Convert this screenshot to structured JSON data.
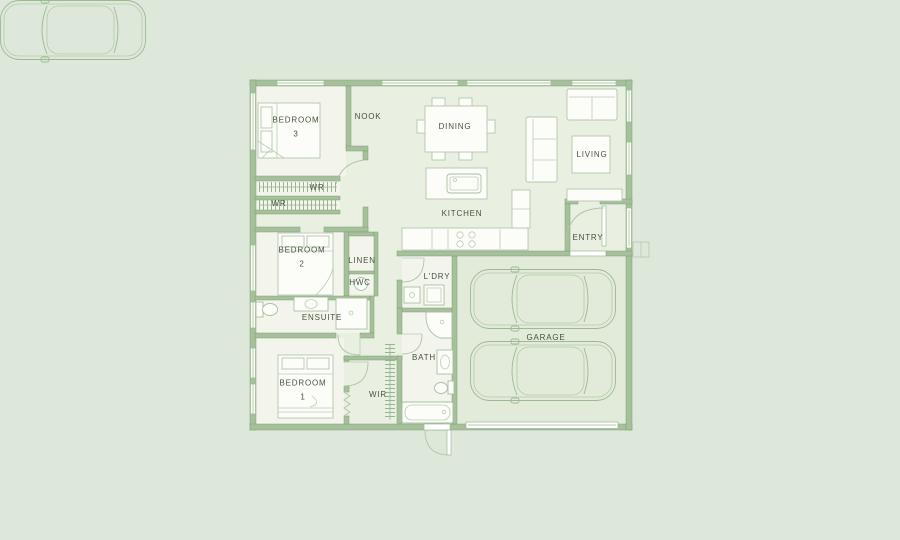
{
  "plan": {
    "colors": {
      "background": "#dee8da",
      "wall": "#a5c09a",
      "interior_floor": "#e9efe1",
      "room_floor": "#f3f5ed",
      "garage_floor": "#e2ebd9",
      "furniture_fill": "#fcfdf8",
      "line": "#9db995",
      "label_text": "#47523f"
    },
    "rooms": {
      "bedroom3": {
        "label": "BEDROOM\n3"
      },
      "nook": {
        "label": "NOOK"
      },
      "dining": {
        "label": "DINING"
      },
      "living": {
        "label": "LIVING"
      },
      "entry": {
        "label": "ENTRY"
      },
      "kitchen": {
        "label": "KITCHEN"
      },
      "wr_top": {
        "label": "WR"
      },
      "wr_side": {
        "label": "WR"
      },
      "bedroom2": {
        "label": "BEDROOM\n2"
      },
      "linen": {
        "label": "LINEN"
      },
      "hwc": {
        "label": "HWC"
      },
      "ensuite": {
        "label": "ENSUITE"
      },
      "laundry": {
        "label": "L'DRY"
      },
      "bath": {
        "label": "BATH"
      },
      "wir": {
        "label": "WIR"
      },
      "bedroom1": {
        "label": "BEDROOM\n1"
      },
      "garage": {
        "label": "GARAGE"
      }
    },
    "furniture": [
      "double-bed-bedroom-3",
      "double-bed-bedroom-2",
      "double-bed-bedroom-1",
      "wardrobe-rail-top",
      "wardrobe-rail-side",
      "wir-shelving",
      "bifold-door",
      "dining-table",
      "dining-chairs",
      "sofa",
      "chaise-sofa",
      "coffee-table",
      "tv-unit",
      "kitchen-island-with-sink",
      "cooktop",
      "tall-cabinet",
      "laundry-tub",
      "washing-machine",
      "ensuite-shower",
      "ensuite-vanity",
      "ensuite-toilet",
      "bath-shower",
      "bath-vanity",
      "bath-toilet",
      "bathtub",
      "hot-water-cylinder",
      "garage-door",
      "entry-step",
      "car-top-view",
      "car-top-view"
    ]
  }
}
